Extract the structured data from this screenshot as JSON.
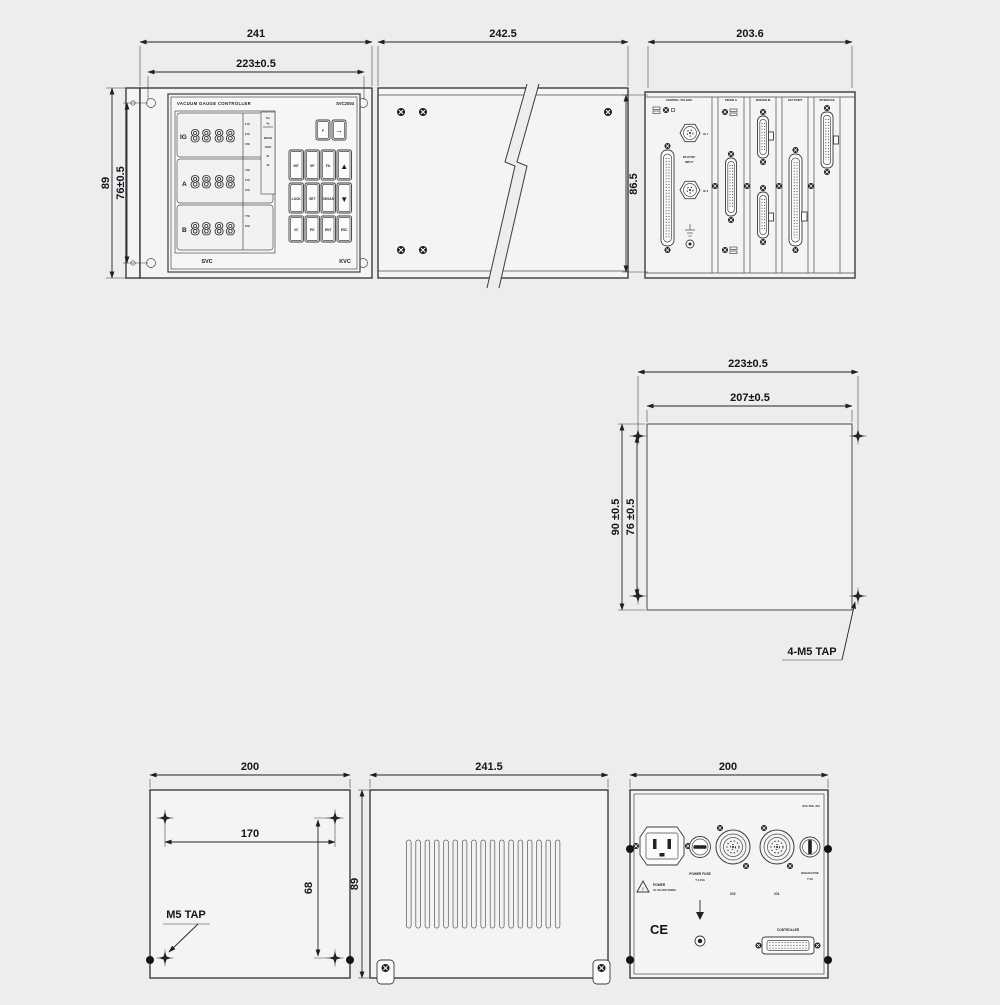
{
  "colors": {
    "background": "#ededed",
    "line": "#3c3c3c",
    "dim_text": "#14141c",
    "panel": "#f4f4f4"
  },
  "front": {
    "dim_w": "241",
    "dim_w2": "223±0.5",
    "dim_h": "89",
    "dim_h2": "76±0.5",
    "title": "VACUUM GAUGE CONTROLLER",
    "model": "SVC2004",
    "brand_left": "SVC",
    "brand_right": "KVC",
    "display_rows": [
      {
        "label": "IG",
        "digits_a": "88",
        "digits_b": "88",
        "leds": [
          "1 M",
          "2 M",
          "3 M"
        ]
      },
      {
        "label": "A",
        "digits_a": "88",
        "digits_b": "88",
        "leds": [
          "4 M",
          "5 M",
          "6 M"
        ]
      },
      {
        "label": "B",
        "digits_a": "88",
        "digits_b": "88",
        "leds": [
          "7 M",
          "8 M"
        ]
      }
    ],
    "side_labels": [
      "Torr",
      "Pa",
      "DEGAS",
      "LOCK",
      "S1",
      "S2"
    ],
    "keys_top": [
      "F",
      "→"
    ],
    "keys": [
      [
        "INT",
        "SP",
        "FIL",
        "▲"
      ],
      [
        "LOCK",
        "SET",
        "DEGAS",
        "▼"
      ],
      [
        "IG",
        "PG",
        "ENT",
        "ESC"
      ]
    ]
  },
  "side": {
    "dim_w": "242.5"
  },
  "rear": {
    "dim_w": "203.6",
    "dim_h": "86.5",
    "headers": [
      "CONTROL / RS-232C",
      "PIRANI G",
      "SENSOR IN",
      "SET POINT",
      "INTERFACE"
    ],
    "pilot1": "PILOT/SP",
    "pilot2": "INPUT",
    "ig1": "IG 1",
    "ig2": "IG 2"
  },
  "mount": {
    "dim_w": "223±0.5",
    "dim_w2": "207±0.5",
    "dim_h": "90 ±0.5",
    "dim_h2": "76 ±0.5",
    "tap": "4-M5 TAP"
  },
  "bottom": {
    "dim_w": "200",
    "dim_w2": "170",
    "dim_h2": "68",
    "tap": "M5 TAP"
  },
  "side2": {
    "dim_w": "241.5",
    "dim_h": "89"
  },
  "power": {
    "dim_w": "200",
    "model": "SVC SOL-47A",
    "power_label": "POWER",
    "power_sub": "AC 100-240V 50/60Hz",
    "fuse_label": "POWER FUSE",
    "fuse_sub": "T 3.15A",
    "ig2": "IG2",
    "ig1": "IG1",
    "degas_label": "DEGAS FUSE",
    "degas_sub": "T 2A",
    "ce": "CE",
    "controller": "CONTROLLER"
  }
}
